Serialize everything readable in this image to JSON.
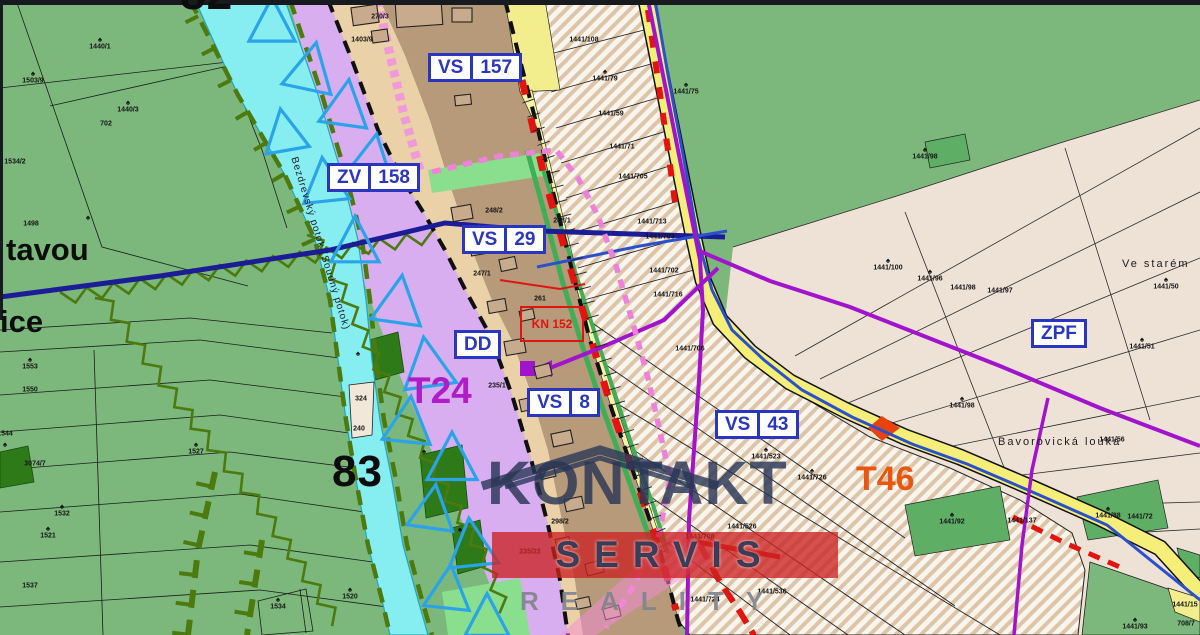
{
  "map": {
    "zone_boxes": [
      {
        "id": "vs157",
        "left": "VS",
        "right": "157"
      },
      {
        "id": "zv158",
        "left": "ZV",
        "right": "158"
      },
      {
        "id": "vs29",
        "left": "VS",
        "right": "29"
      },
      {
        "id": "vs8",
        "left": "VS",
        "right": "8"
      },
      {
        "id": "vs43",
        "left": "VS",
        "right": "43"
      },
      {
        "id": "dd",
        "left": "DD",
        "right": null
      },
      {
        "id": "zpf",
        "left": "ZPF",
        "right": null
      }
    ],
    "red_parcel_box": {
      "text": "KN 152"
    },
    "big_labels": {
      "num82": "82",
      "num83": "83",
      "t24": "T24",
      "t46": "T46",
      "place_tavou": "tavou",
      "place_ice": "ice",
      "ve_starem": "Ve starém",
      "louka": "Bavorovická louka",
      "stream": "Bezdrevský potok (Soudný potok)"
    },
    "watermark": {
      "title": "KONTAKT",
      "band": "SERVIS",
      "sub": "REALITY"
    },
    "colors": {
      "field_green": "#7cb87c",
      "flood_lavender": "#d8aef0",
      "stream_cyan": "#86eef0",
      "village_brown": "#b69a7a",
      "road_yellow": "#f5ef7a",
      "hatch_beige": "#dcc5aa",
      "meadow_cream": "#eee1d6",
      "zone_blue": "#2a35c0",
      "zone_red": "#e21410",
      "utility_purple": "#a114cc",
      "water_navy": "#1c1c96",
      "pipe_blue": "#2b50cc",
      "triangle_cyan": "#2aa3e8",
      "chain_pink": "#ee82d8",
      "tree_olive": "#4c7a0e",
      "t24_magenta": "#b01cc8",
      "t46_orange": "#e8560f"
    },
    "parcel_numbers": [
      [
        "1440/1",
        100,
        47
      ],
      [
        "1503/9",
        33,
        81
      ],
      [
        "1440/3",
        128,
        110
      ],
      [
        "702",
        106,
        124
      ],
      [
        "1534/2",
        15,
        162
      ],
      [
        "1498",
        31,
        224
      ],
      [
        "1553",
        30,
        367
      ],
      [
        "1550",
        30,
        390
      ],
      [
        "1544",
        5,
        434
      ],
      [
        "3074/7",
        35,
        464
      ],
      [
        "1532",
        62,
        514
      ],
      [
        "1521",
        48,
        536
      ],
      [
        "1527",
        196,
        452
      ],
      [
        "1537",
        30,
        586
      ],
      [
        "1534",
        278,
        607
      ],
      [
        "1520",
        350,
        597
      ],
      [
        "324",
        361,
        399
      ],
      [
        "240",
        359,
        429
      ],
      [
        "270/3",
        380,
        17
      ],
      [
        "1403/9",
        362,
        40
      ],
      [
        "248/2",
        494,
        211
      ],
      [
        "248/1",
        562,
        221
      ],
      [
        "247/1",
        482,
        274
      ],
      [
        "261",
        540,
        299
      ],
      [
        "235/1",
        497,
        386
      ],
      [
        "235/22",
        530,
        552
      ],
      [
        "298/2",
        560,
        522
      ],
      [
        "1441/108",
        584,
        40
      ],
      [
        "1441/79",
        605,
        79
      ],
      [
        "1441/59",
        611,
        114
      ],
      [
        "1441/75",
        686,
        92
      ],
      [
        "1441/71",
        622,
        147
      ],
      [
        "1441/705",
        633,
        177
      ],
      [
        "1441/713",
        652,
        222
      ],
      [
        "1441/703",
        660,
        237
      ],
      [
        "1441/702",
        664,
        271
      ],
      [
        "1441/716",
        668,
        295
      ],
      [
        "1441/706",
        690,
        349
      ],
      [
        "1441/523",
        766,
        457
      ],
      [
        "1441/726",
        812,
        478
      ],
      [
        "1441/526",
        742,
        527
      ],
      [
        "1441/708",
        700,
        537
      ],
      [
        "1441/536",
        772,
        592
      ],
      [
        "1441/724",
        705,
        600
      ],
      [
        "1441/98",
        925,
        157
      ],
      [
        "1441/100",
        888,
        268
      ],
      [
        "1441/96",
        930,
        279
      ],
      [
        "1441/98",
        963,
        288
      ],
      [
        "1441/97",
        1000,
        291
      ],
      [
        "1441/50",
        1166,
        287
      ],
      [
        "1441/51",
        1142,
        347
      ],
      [
        "1441/98",
        962,
        406
      ],
      [
        "1441/56",
        1112,
        440
      ],
      [
        "1441/88",
        1108,
        516
      ],
      [
        "1441/72",
        1140,
        517
      ],
      [
        "1441/137",
        1022,
        521
      ],
      [
        "1441/92",
        952,
        522
      ],
      [
        "1441/93",
        1135,
        627
      ],
      [
        "708/7",
        1186,
        624
      ],
      [
        "1441/15",
        1185,
        605
      ]
    ],
    "trees": [
      [
        100,
        40
      ],
      [
        33,
        74
      ],
      [
        128,
        103
      ],
      [
        88,
        218
      ],
      [
        30,
        360
      ],
      [
        62,
        507
      ],
      [
        48,
        529
      ],
      [
        196,
        445
      ],
      [
        278,
        600
      ],
      [
        350,
        590
      ],
      [
        686,
        85
      ],
      [
        605,
        72
      ],
      [
        766,
        450
      ],
      [
        812,
        471
      ],
      [
        888,
        261
      ],
      [
        930,
        272
      ],
      [
        962,
        399
      ],
      [
        1142,
        340
      ],
      [
        1166,
        280
      ],
      [
        925,
        150
      ],
      [
        952,
        515
      ],
      [
        1108,
        509
      ],
      [
        1135,
        620
      ],
      [
        358,
        354
      ],
      [
        424,
        452
      ],
      [
        460,
        530
      ],
      [
        5,
        445
      ]
    ],
    "triangles": [
      [
        272,
        25,
        46,
        0
      ],
      [
        310,
        72,
        50,
        12
      ],
      [
        285,
        135,
        44,
        -10
      ],
      [
        345,
        108,
        48,
        8
      ],
      [
        325,
        185,
        46,
        -6
      ],
      [
        372,
        160,
        44,
        10
      ],
      [
        355,
        245,
        48,
        0
      ],
      [
        398,
        305,
        50,
        8
      ],
      [
        428,
        368,
        52,
        -8
      ],
      [
        408,
        425,
        48,
        6
      ],
      [
        452,
        462,
        50,
        0
      ],
      [
        432,
        512,
        46,
        8
      ],
      [
        472,
        548,
        50,
        -6
      ],
      [
        448,
        592,
        46,
        6
      ],
      [
        487,
        620,
        44,
        0
      ]
    ]
  }
}
